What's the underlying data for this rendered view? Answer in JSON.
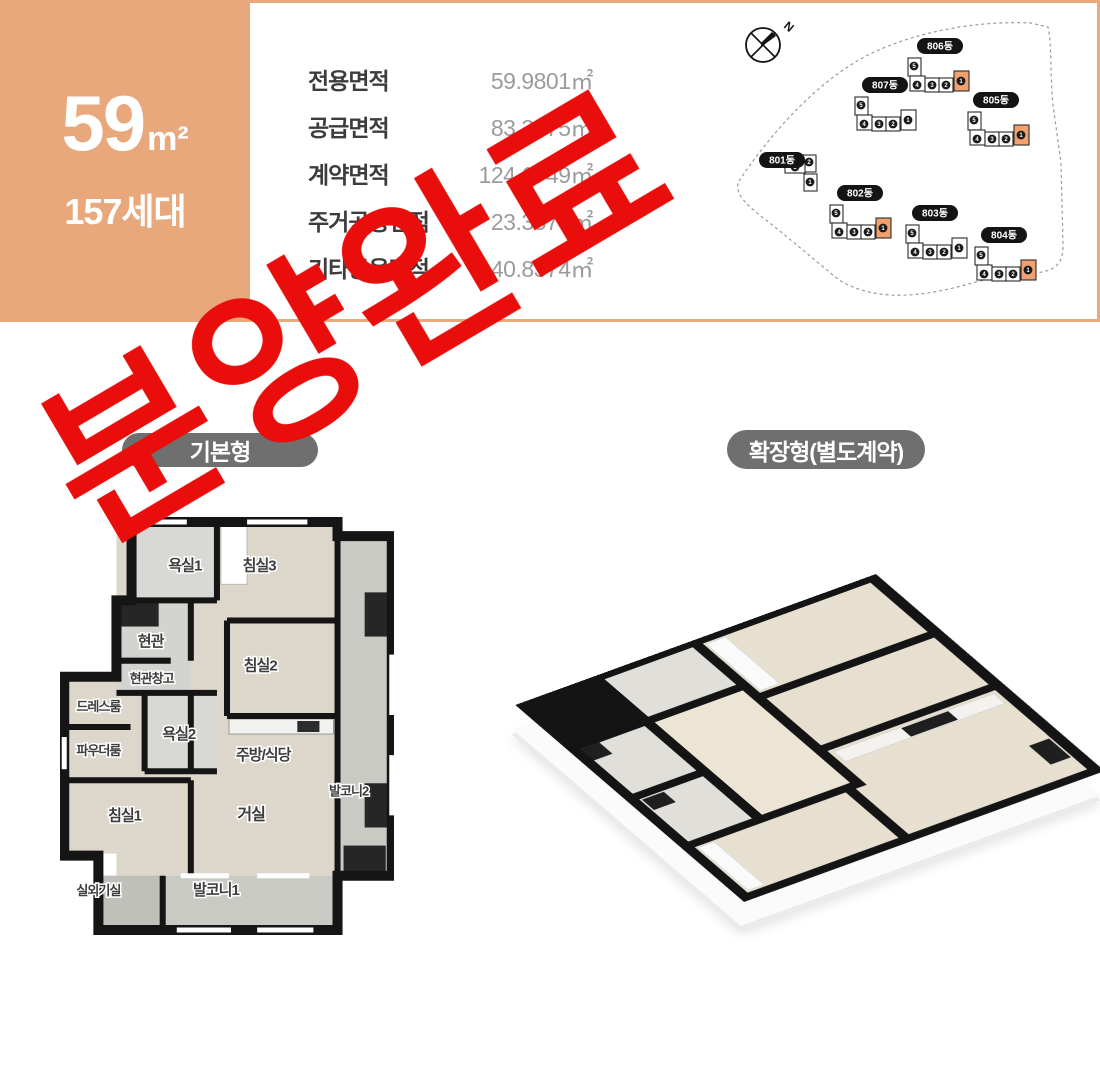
{
  "colors": {
    "accent_salmon": "#e9a87c",
    "stamp_red": "#e90d0b",
    "pill_gray": "#6f6f6f",
    "map_highlight_orange": "#f2a16e"
  },
  "unit_summary": {
    "area_number": "59",
    "area_unit": "m²",
    "households": "157세대"
  },
  "area_table": {
    "rows": [
      {
        "label": "전용면적",
        "value": "59.9801㎡"
      },
      {
        "label": "공급면적",
        "value": "83.3375㎡"
      },
      {
        "label": "계약면적",
        "value": "124.1749㎡"
      },
      {
        "label": "주거공용면적",
        "value": "23.3574㎡"
      },
      {
        "label": "기타공용면적",
        "value": "40.8374㎡"
      }
    ]
  },
  "stamp": {
    "text": "분양완료"
  },
  "site_map": {
    "north_label": "N",
    "buildings": [
      {
        "name": "801동",
        "cx": 51,
        "cy": 147,
        "x": 64,
        "y": 142,
        "shape": "t",
        "highlight": false
      },
      {
        "name": "802동",
        "cx": 129,
        "cy": 180,
        "x": 99,
        "y": 192,
        "shape": "l",
        "highlight": true
      },
      {
        "name": "803동",
        "cx": 204,
        "cy": 200,
        "x": 175,
        "y": 212,
        "shape": "l",
        "highlight": false
      },
      {
        "name": "804동",
        "cx": 273,
        "cy": 222,
        "x": 244,
        "y": 234,
        "shape": "l",
        "highlight": true
      },
      {
        "name": "805동",
        "cx": 265,
        "cy": 87,
        "x": 237,
        "y": 99,
        "shape": "l",
        "highlight": true
      },
      {
        "name": "806동",
        "cx": 209,
        "cy": 33,
        "x": 177,
        "y": 45,
        "shape": "l",
        "highlight": true
      },
      {
        "name": "807동",
        "cx": 154,
        "cy": 72,
        "x": 124,
        "y": 84,
        "shape": "l",
        "highlight": false
      }
    ]
  },
  "plans": {
    "basic": {
      "label": "기본형",
      "room_labels": [
        {
          "t": "욕실1",
          "x": 124,
          "y": 56,
          "s": 15
        },
        {
          "t": "침실3",
          "x": 198,
          "y": 56,
          "s": 15
        },
        {
          "t": "현관",
          "x": 90,
          "y": 132,
          "s": 15
        },
        {
          "t": "현관창고",
          "x": 91,
          "y": 168,
          "s": 13
        },
        {
          "t": "침실2",
          "x": 199,
          "y": 156,
          "s": 15
        },
        {
          "t": "드레스룸",
          "x": 38,
          "y": 196,
          "s": 13
        },
        {
          "t": "욕실2",
          "x": 118,
          "y": 224,
          "s": 15
        },
        {
          "t": "파우더룸",
          "x": 38,
          "y": 240,
          "s": 13
        },
        {
          "t": "주방/식당",
          "x": 202,
          "y": 245,
          "s": 15
        },
        {
          "t": "발코니2",
          "x": 287,
          "y": 280,
          "s": 13
        },
        {
          "t": "침실1",
          "x": 64,
          "y": 305,
          "s": 15
        },
        {
          "t": "거실",
          "x": 190,
          "y": 304,
          "s": 16
        },
        {
          "t": "실외기실",
          "x": 38,
          "y": 379,
          "s": 13
        },
        {
          "t": "발코니1",
          "x": 155,
          "y": 379,
          "s": 15
        }
      ]
    },
    "extended": {
      "label": "확장형(별도계약)"
    }
  }
}
